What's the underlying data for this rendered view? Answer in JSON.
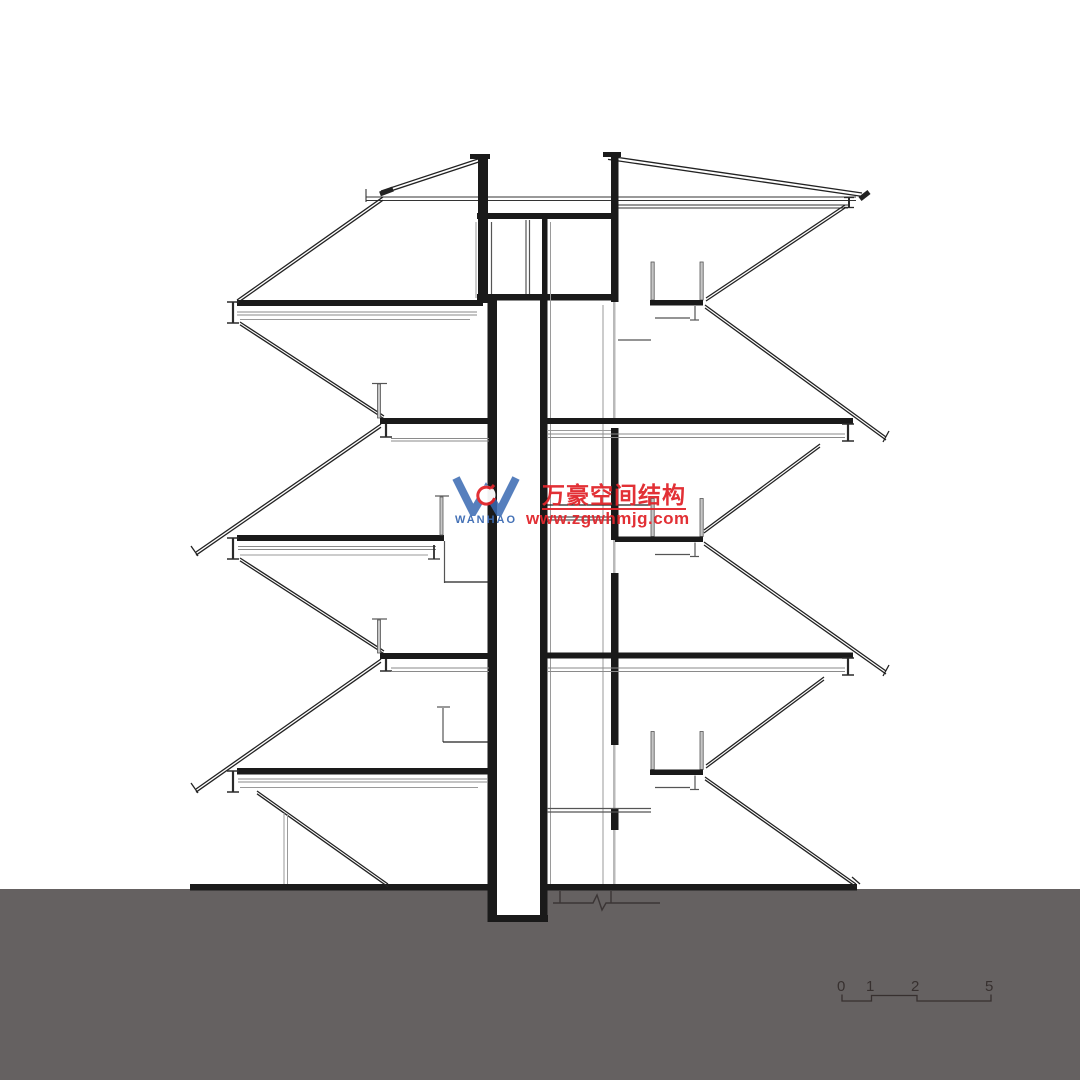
{
  "watermark": {
    "logo_text": "WANHAO",
    "brand_cn": "万豪空间结构",
    "url": "www.zgwhmjg.com"
  },
  "scale_bar": {
    "labels": [
      "0",
      "1",
      "2",
      "5"
    ]
  },
  "colors": {
    "watermark_red": "#e1252b",
    "watermark_blue": "#3a6ab3",
    "ground_gray": "#656161",
    "line_black": "#1a1a1a",
    "scale_text": "#37302f"
  }
}
